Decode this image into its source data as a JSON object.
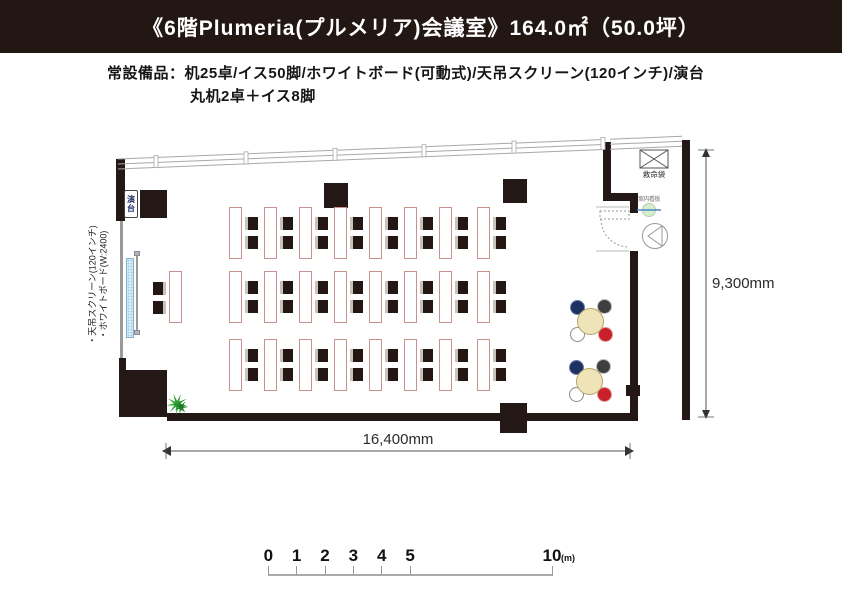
{
  "header": {
    "title": "《6階Plumeria(プルメリア)会議室》164.0㎡（50.0坪）"
  },
  "equipment_note": {
    "line1": "常設備品：机25卓/イス50脚/ホワイトボード(可動式)/天吊スクリーン(120インチ)/演台",
    "line2": "丸机2卓＋イス8脚"
  },
  "plan": {
    "labels": {
      "podium": "演台",
      "rescue_bag": "救命袋",
      "info_board": "案内看板",
      "ceiling_screen_note": "・天吊スクリーン(120インチ)",
      "whiteboard_note": "・ホワイトボード(W:2400)"
    },
    "dimensions": {
      "width_label": "16,400mm",
      "height_label": "9,300mm"
    },
    "furniture": {
      "rect_table_rows": [
        8,
        9,
        8
      ],
      "rect_table_total": 25,
      "chairs_per_rect_table": 2,
      "rect_chair_total": 50,
      "round_tables": 2,
      "round_table_chairs": 8,
      "colors": {
        "table_fill": "#f6eae3",
        "table_border": "#c9918c",
        "chair_dark": "#241713",
        "round_table_fill": "#efe3b8",
        "round_chair_navy": "#1d3260",
        "round_chair_gray": "#3f3f3f",
        "round_chair_white": "#ffffff",
        "round_chair_red": "#c9202a",
        "wall": "#231815",
        "plant_green": "#2aa12f"
      }
    }
  },
  "scale_bar": {
    "ticks": [
      0,
      1,
      2,
      3,
      4,
      5,
      10
    ],
    "unit": "(m)"
  }
}
